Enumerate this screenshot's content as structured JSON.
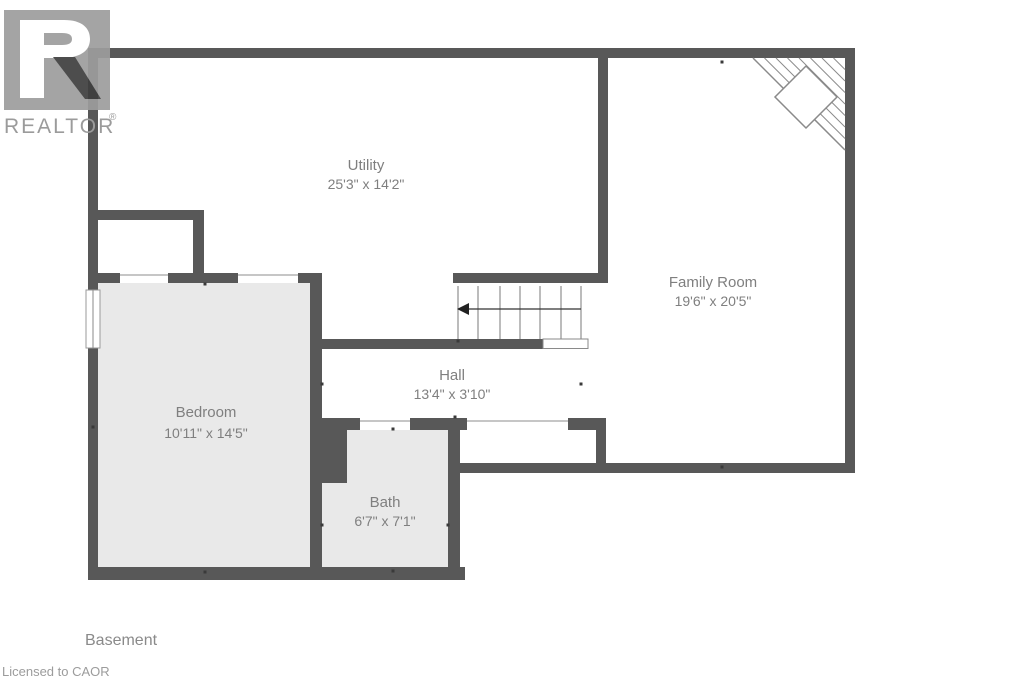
{
  "branding": {
    "logo_text": "REALTOR",
    "registered_mark": "®",
    "license_note": "Licensed to CAOR"
  },
  "floor": {
    "name": "Basement"
  },
  "rooms": [
    {
      "id": "utility",
      "name": "Utility",
      "dimensions": "25'3\" x 14'2\""
    },
    {
      "id": "family-room",
      "name": "Family Room",
      "dimensions": "19'6\" x 20'5\""
    },
    {
      "id": "hall",
      "name": "Hall",
      "dimensions": "13'4\" x 3'10\""
    },
    {
      "id": "bedroom",
      "name": "Bedroom",
      "dimensions": "10'11\" x 14'5\""
    },
    {
      "id": "bath",
      "name": "Bath",
      "dimensions": "6'7\" x 7'1\""
    }
  ],
  "colors": {
    "wall": "#585858",
    "room_fill": "#e9e9e9",
    "label_text": "#7f7f7f",
    "logo_gray": "#9d9d9d",
    "logo_leg_dark": "#3e3e3e"
  }
}
